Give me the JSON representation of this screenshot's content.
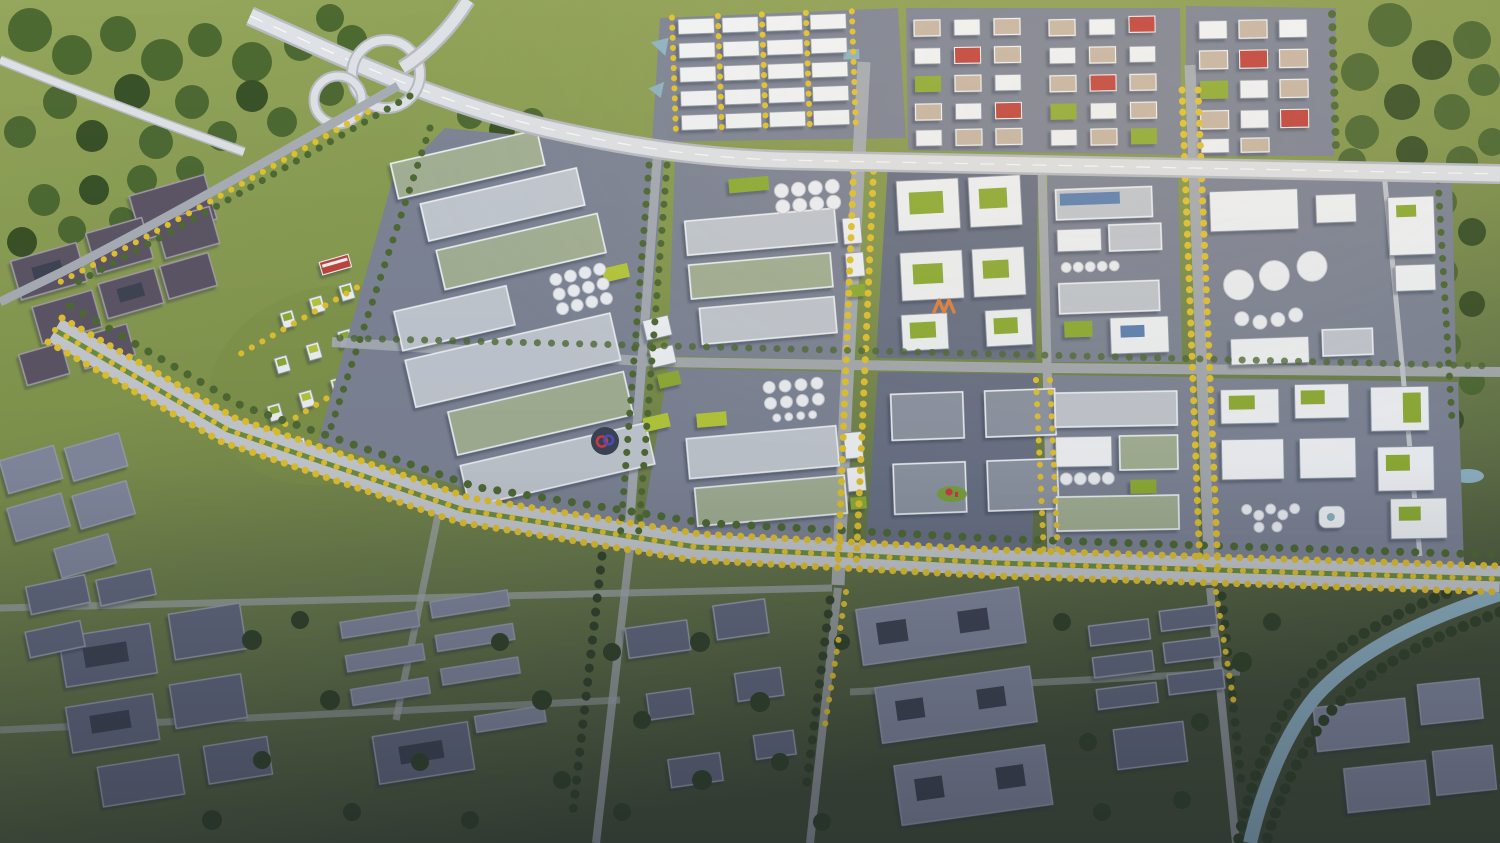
{
  "meta": {
    "title": "Aerial 3D masterplan rendering of a planned industrial park beside an existing town",
    "render_type": "photorealistic architectural bird's-eye render",
    "no_visible_text": true,
    "lighting": "low warm sun from the upper right, dusk shading toward the bottom of the frame"
  },
  "scene": {
    "regions": [
      {
        "id": "highway-interchange",
        "label": "Cloverleaf highway interchange with looping ramps, top left"
      },
      {
        "id": "elevated-expressway",
        "label": "Elevated expressway running east across the north edge of the park"
      },
      {
        "id": "logistics-warehouses",
        "label": "Rows of white logistics warehouses lined with yellow ginkgo trees, top centre"
      },
      {
        "id": "factory-blocks",
        "label": "Grid of factory blocks with grey, sage and vivid green roofs, white silos and blue solar panels"
      },
      {
        "id": "tank-farm",
        "label": "Cluster of large white storage tanks in the north-east block"
      },
      {
        "id": "business-towers",
        "label": "Mid-rise office towers with green roofs among yellow trees, west side"
      },
      {
        "id": "old-town-west",
        "label": "Existing grey courtyard blocks, far west"
      },
      {
        "id": "main-arterial",
        "label": "Main boulevard with green median and yellow autumn street trees crossing the whole site"
      },
      {
        "id": "existing-town-south",
        "label": "Existing town blocks and dense green trees in shadow, southern half"
      },
      {
        "id": "canal",
        "label": "Tree-lined canal cutting the south-east corner"
      },
      {
        "id": "fields",
        "label": "Green farmland and woodland surrounding the site"
      }
    ],
    "landmarks": [
      {
        "id": "logo-disc",
        "label": "Circular plaza logo with red and blue ribbon marks",
        "x": 605,
        "y": 441,
        "colors": {
          "disc": "#3b4456",
          "red": "#d63a45",
          "blue": "#4a52c0"
        }
      },
      {
        "id": "w-sculpture",
        "label": "Orange W-shaped sculpture in factory courtyard",
        "x": 946,
        "y": 306,
        "colors": {
          "stroke": "#e0823f"
        }
      },
      {
        "id": "red-sculpture",
        "label": "Red sculpture on a green oval island",
        "x": 952,
        "y": 494,
        "colors": {
          "sculpture": "#cf3a4a",
          "island": "#7ba33d"
        }
      }
    ]
  },
  "palette": {
    "field": "#8a9d52",
    "field-light": "#9cac60",
    "forest": "#4e6a33",
    "forest-dark": "#3a5228",
    "forest-dim": "#33452b",
    "pavement": "#7e8596",
    "pavement-dark": "#6a7286",
    "roof": "#c3c9d1",
    "roof-sage": "#a4b195",
    "roof-dark": "#8e96a4",
    "roof-tan": "#c8b7a5",
    "wall": "#f1f4f7",
    "green-roof": "#8fae34",
    "lawn": "#b7c93a",
    "solar": "#5d82b4",
    "tank": "#eff2f5",
    "road": "#a9aeb6",
    "road-light": "#c7cbd1",
    "highway": "#dfe2e6",
    "highway-edge": "#b7bcc3",
    "median": "#6f8f3f",
    "ytree": "#e2c32f",
    "ytree-dark": "#c5a326",
    "water": "#8fb3c4",
    "town-wall": "#9ba1b2",
    "town-roof": "#656c81",
    "town-roof-light": "#848ba0",
    "oldtown-wall": "#a79fae",
    "oldtown-roof": "#5d5766",
    "accent-red": "#c2443c",
    "dusk": "#161b28"
  }
}
